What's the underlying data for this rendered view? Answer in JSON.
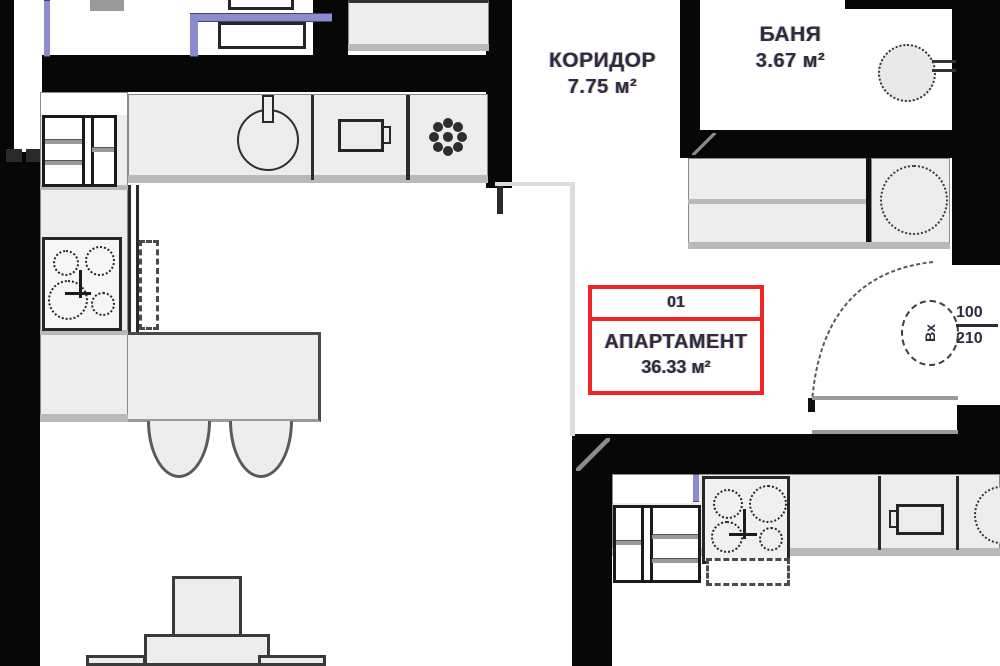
{
  "rooms": {
    "corridor": {
      "name": "КОРИДОР",
      "area": "7.75 м²"
    },
    "bathroom": {
      "name": "БАНЯ",
      "area": "3.67 м²"
    }
  },
  "apartment_label": {
    "number": "01",
    "title": "АПАРТАМЕНТ",
    "area": "36.33 м²"
  },
  "entry_door": {
    "mark": "Вх",
    "width_cm": "100",
    "height_cm": "210"
  },
  "icons": {
    "stove": "four-burner-cooktop",
    "sink": "round-sink-with-tap",
    "vent": "flower-fan-symbol",
    "washbasin": "round-basin",
    "door_swing": "quarter-arc"
  },
  "colors": {
    "wall": "#070707",
    "counter_fill": "#ededed",
    "counter_edge": "#b9b9b9",
    "accent_purple": "#8b8bd0",
    "highlight_red": "#ee2426",
    "label_text": "#2c2c3e"
  }
}
